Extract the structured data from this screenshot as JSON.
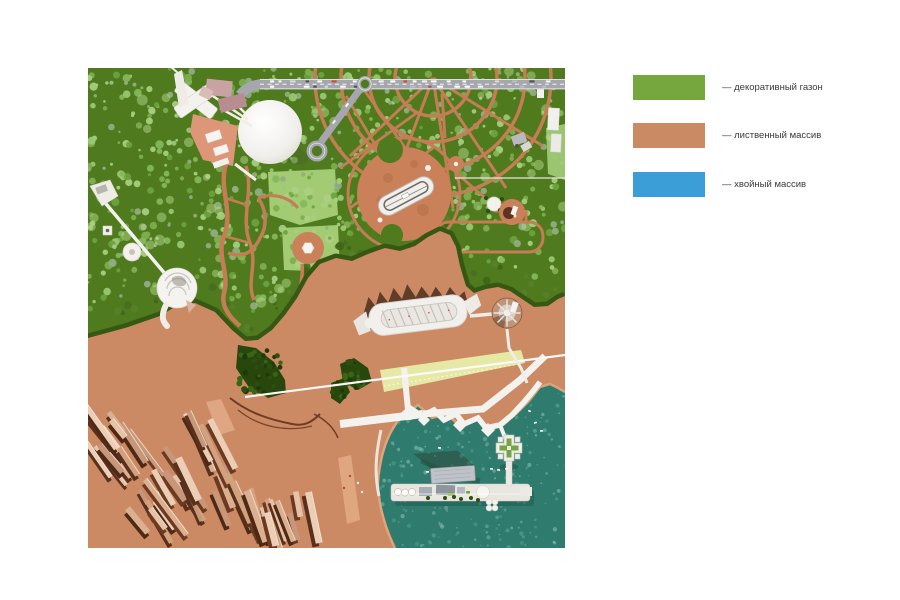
{
  "legend": {
    "items": [
      {
        "label": "— декоративный газон",
        "color": "#76a73e"
      },
      {
        "label": "— лиственный массив",
        "color": "#c98a64"
      },
      {
        "label": "— хвойный массив",
        "color": "#3b9ed6"
      }
    ]
  },
  "map": {
    "colors": {
      "lawn_green": "#4f7a1d",
      "lawn_light": "#a3cb74",
      "terrain_orange": "#cb8a63",
      "water_teal": "#2f7b6d",
      "path_orange": "#c47d54",
      "road_gray": "#a6a6ae",
      "dark_forest": "#365812",
      "beach_yellow": "#e6e9a5",
      "white_structure": "#f3f1ed",
      "tree_palette": [
        "#6da33f",
        "#85b95b",
        "#9ac974",
        "#7fae4e",
        "#a8cf82",
        "#93ad85"
      ],
      "tree_palette_dark": [
        "#486e1f",
        "#3f6418",
        "#587f2a"
      ],
      "dark_tree_dots": [
        "#1d3a08",
        "#2c4f10",
        "#3c6418"
      ],
      "city_tans": [
        "#e6c3a8",
        "#dbb091",
        "#d2a27f",
        "#c89679",
        "#eccdb5"
      ],
      "city_shadows": [
        "#4e2a16",
        "#6b3a20",
        "#59301b"
      ],
      "ripple_colors": [
        "#6fb3a3",
        "#8ac4b5",
        "#5aa893",
        "#a5d4c6"
      ],
      "car_colors": [
        "#ffffff",
        "#f2f2f4",
        "#c94b3e",
        "#50545c",
        "#d9d9dc",
        "#b7bcc4",
        "#ffffff"
      ]
    }
  }
}
